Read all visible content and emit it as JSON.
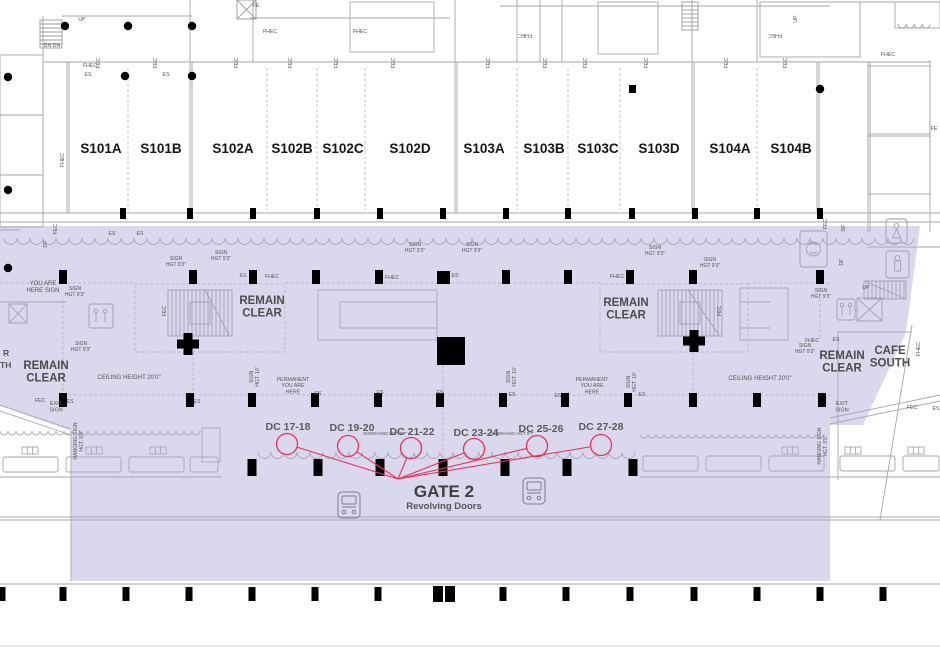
{
  "colors": {
    "overlay": "rgba(174,169,212,0.45)",
    "annotation_red": "#ee3056",
    "wall_gray": "#a5a5a5",
    "column_black": "#000000",
    "label_gray": "#555555"
  },
  "halls": [
    {
      "t": "S101A",
      "x": 101
    },
    {
      "t": "S101B",
      "x": 161
    },
    {
      "t": "S102A",
      "x": 233
    },
    {
      "t": "S102B",
      "x": 292
    },
    {
      "t": "S102C",
      "x": 343
    },
    {
      "t": "S102D",
      "x": 410
    },
    {
      "t": "S103A",
      "x": 484
    },
    {
      "t": "S103B",
      "x": 544
    },
    {
      "t": "S103C",
      "x": 598
    },
    {
      "t": "S103D",
      "x": 659
    },
    {
      "t": "S104A",
      "x": 730
    },
    {
      "t": "S104B",
      "x": 791
    }
  ],
  "gate": {
    "t": "GATE 2",
    "sub": "Revolving Doors"
  },
  "doors": {
    "converge": {
      "x": 398,
      "y": 479
    },
    "items": [
      {
        "t": "DC 17-18",
        "cx": 287,
        "cy": 444,
        "lx": 288,
        "ly": 430
      },
      {
        "t": "DC 19-20",
        "cx": 348,
        "cy": 446,
        "lx": 352,
        "ly": 431
      },
      {
        "t": "DC 21-22",
        "cx": 411,
        "cy": 448,
        "lx": 412,
        "ly": 435
      },
      {
        "t": "DC 23-24",
        "cx": 474,
        "cy": 449,
        "lx": 476,
        "ly": 436
      },
      {
        "t": "DC 25-26",
        "cx": 537,
        "cy": 446,
        "lx": 541,
        "ly": 432
      },
      {
        "t": "DC 27-28",
        "cx": 601,
        "cy": 445,
        "lx": 601,
        "ly": 430
      }
    ]
  },
  "zones": [
    {
      "lines": [
        "REMAIN",
        "CLEAR"
      ],
      "x": 46,
      "y": 369
    },
    {
      "lines": [
        "REMAIN",
        "CLEAR"
      ],
      "x": 262,
      "y": 304
    },
    {
      "lines": [
        "REMAIN",
        "CLEAR"
      ],
      "x": 626,
      "y": 306
    },
    {
      "lines": [
        "REMAIN",
        "CLEAR"
      ],
      "x": 842,
      "y": 359
    },
    {
      "lines": [
        "CAFE",
        "SOUTH"
      ],
      "x": 890,
      "y": 354
    }
  ],
  "notes": [
    {
      "lines": [
        "YOU ARE",
        "HERE SIGN"
      ],
      "x": 43,
      "y": 285,
      "s": 6
    },
    {
      "lines": [
        "CEILING HEIGHT 20'0\""
      ],
      "x": 129,
      "y": 379,
      "s": 6
    },
    {
      "lines": [
        "CEILING HEIGHT 20'0\""
      ],
      "x": 760,
      "y": 380,
      "s": 6
    },
    {
      "lines": [
        "PERMANENT",
        "YOU ARE",
        "HERE"
      ],
      "x": 293,
      "y": 381,
      "s": 5.2
    },
    {
      "lines": [
        "PERMANENT",
        "YOU ARE",
        "HERE"
      ],
      "x": 592,
      "y": 381,
      "s": 5.2
    },
    {
      "lines": [
        "EXIT",
        "SIGN"
      ],
      "x": 56,
      "y": 405,
      "s": 5.5
    },
    {
      "lines": [
        "EXIT",
        "SIGN"
      ],
      "x": 842,
      "y": 405,
      "s": 5.5
    },
    {
      "lines": [
        "OVERHANG HGT 9'7\""
      ],
      "x": 385,
      "y": 435,
      "s": 4.4
    },
    {
      "lines": [
        "OVERHANG HGT 9'7\""
      ],
      "x": 512,
      "y": 435,
      "s": 4.4
    },
    {
      "lines": [
        "SIGN",
        "HGT 9'3\""
      ],
      "x": 75,
      "y": 290,
      "s": 5
    },
    {
      "lines": [
        "SIGN",
        "HGT 9'3\""
      ],
      "x": 81,
      "y": 345,
      "s": 5
    },
    {
      "lines": [
        "SIGN",
        "HGT 9'3\""
      ],
      "x": 176,
      "y": 260,
      "s": 5
    },
    {
      "lines": [
        "SIGN",
        "HGT 9'3\""
      ],
      "x": 221,
      "y": 254,
      "s": 5
    },
    {
      "lines": [
        "SIGN",
        "HGT 9'3\""
      ],
      "x": 415,
      "y": 246,
      "s": 5
    },
    {
      "lines": [
        "SIGN",
        "HGT 9'3\""
      ],
      "x": 472,
      "y": 246,
      "s": 5
    },
    {
      "lines": [
        "SIGN",
        "HGT 9'3\""
      ],
      "x": 655,
      "y": 249,
      "s": 5
    },
    {
      "lines": [
        "SIGN",
        "HGT 9'3\""
      ],
      "x": 710,
      "y": 261,
      "s": 5
    },
    {
      "lines": [
        "SIGN",
        "HGT 9'3\""
      ],
      "x": 821,
      "y": 292,
      "s": 5
    },
    {
      "lines": [
        "SIGN",
        "HGT 9'3\""
      ],
      "x": 805,
      "y": 347,
      "s": 5
    },
    {
      "lines": [
        "SIGN",
        "HGT. 10'"
      ],
      "x": 253,
      "y": 377,
      "s": 5,
      "rot": -90
    },
    {
      "lines": [
        "SIGN",
        "HGT. 10'"
      ],
      "x": 510,
      "y": 377,
      "s": 5,
      "rot": -90
    },
    {
      "lines": [
        "SIGN",
        "HGT. 10'"
      ],
      "x": 630,
      "y": 382,
      "s": 5,
      "rot": -90
    },
    {
      "lines": [
        "HANGING SIGN",
        "HGT. 9'9\""
      ],
      "x": 77,
      "y": 441,
      "s": 5,
      "rot": -90
    },
    {
      "lines": [
        "HANGING SIGN",
        "HGT. 9'9\""
      ],
      "x": 821,
      "y": 446,
      "s": 5,
      "rot": -90
    },
    {
      "lines": [
        "R"
      ],
      "x": 3,
      "y": 356,
      "s": 8.5,
      "b": 1,
      "anchor": "start"
    },
    {
      "lines": [
        "TH"
      ],
      "x": 0,
      "y": 368,
      "s": 8.5,
      "b": 1,
      "anchor": "start"
    }
  ],
  "tiny": [
    {
      "t": "UP",
      "x": 82,
      "y": 21
    },
    {
      "t": "UP",
      "x": 866,
      "y": 289
    },
    {
      "t": "UP",
      "x": 797,
      "y": 19,
      "rot": -90
    },
    {
      "t": "DN DN",
      "x": 52,
      "y": 47
    },
    {
      "t": "FE",
      "x": 256,
      "y": 7
    },
    {
      "t": "FE",
      "x": 934,
      "y": 130
    },
    {
      "t": "FHEC",
      "x": 90,
      "y": 67
    },
    {
      "t": "FHEC",
      "x": 270,
      "y": 33
    },
    {
      "t": "FHEC",
      "x": 360,
      "y": 33
    },
    {
      "t": "FHEC",
      "x": 888,
      "y": 56
    },
    {
      "t": "FHEC",
      "x": 272,
      "y": 278
    },
    {
      "t": "FHEC",
      "x": 392,
      "y": 279
    },
    {
      "t": "FHEC",
      "x": 617,
      "y": 278
    },
    {
      "t": "FHEC",
      "x": 812,
      "y": 342
    },
    {
      "t": "FHEC",
      "x": 525,
      "y": 34,
      "rot": 180
    },
    {
      "t": "FHEC",
      "x": 775,
      "y": 34,
      "rot": 180
    },
    {
      "t": "FHEC",
      "x": 64,
      "y": 160,
      "rot": -90
    },
    {
      "t": "FHEC",
      "x": 920,
      "y": 349,
      "rot": -90
    },
    {
      "t": "FEC",
      "x": 100,
      "y": 63,
      "rot": -90
    },
    {
      "t": "FEC",
      "x": 157,
      "y": 63,
      "rot": -90
    },
    {
      "t": "FEC",
      "x": 238,
      "y": 63,
      "rot": -90
    },
    {
      "t": "FEC",
      "x": 292,
      "y": 63,
      "rot": -90
    },
    {
      "t": "FEC",
      "x": 338,
      "y": 63,
      "rot": -90
    },
    {
      "t": "FEC",
      "x": 395,
      "y": 63,
      "rot": -90
    },
    {
      "t": "FEC",
      "x": 490,
      "y": 63,
      "rot": -90
    },
    {
      "t": "FEC",
      "x": 547,
      "y": 63,
      "rot": -90
    },
    {
      "t": "FEC",
      "x": 587,
      "y": 63,
      "rot": -90
    },
    {
      "t": "FEC",
      "x": 648,
      "y": 63,
      "rot": -90
    },
    {
      "t": "FEC",
      "x": 728,
      "y": 63,
      "rot": -90
    },
    {
      "t": "FEC",
      "x": 787,
      "y": 63,
      "rot": -90
    },
    {
      "t": "FEC",
      "x": 57,
      "y": 229,
      "rot": -90
    },
    {
      "t": "FEC",
      "x": 166,
      "y": 311,
      "rot": -90
    },
    {
      "t": "FEC",
      "x": 721,
      "y": 311,
      "rot": -90
    },
    {
      "t": "FEC",
      "x": 827,
      "y": 224,
      "rot": -90
    },
    {
      "t": "FEC",
      "x": 40,
      "y": 402
    },
    {
      "t": "FEC",
      "x": 912,
      "y": 409
    },
    {
      "t": "DF",
      "x": 47,
      "y": 244,
      "rot": -90
    },
    {
      "t": "DF",
      "x": 845,
      "y": 228,
      "rot": -90
    },
    {
      "t": "DF",
      "x": 843,
      "y": 262,
      "rot": -90
    },
    {
      "t": "ES",
      "x": 88,
      "y": 76
    },
    {
      "t": "ES",
      "x": 166,
      "y": 76
    },
    {
      "t": "ES",
      "x": 112,
      "y": 235
    },
    {
      "t": "ES",
      "x": 140,
      "y": 235
    },
    {
      "t": "ES",
      "x": 243,
      "y": 277
    },
    {
      "t": "ES",
      "x": 455,
      "y": 277
    },
    {
      "t": "ES",
      "x": 836,
      "y": 341
    },
    {
      "t": "ES",
      "x": 70,
      "y": 403
    },
    {
      "t": "ES",
      "x": 197,
      "y": 403
    },
    {
      "t": "ES",
      "x": 318,
      "y": 395
    },
    {
      "t": "ES",
      "x": 380,
      "y": 394
    },
    {
      "t": "ES",
      "x": 440,
      "y": 394
    },
    {
      "t": "ES",
      "x": 512,
      "y": 396
    },
    {
      "t": "ES",
      "x": 558,
      "y": 397
    },
    {
      "t": "ES",
      "x": 642,
      "y": 396
    },
    {
      "t": "ES",
      "x": 936,
      "y": 410
    }
  ]
}
